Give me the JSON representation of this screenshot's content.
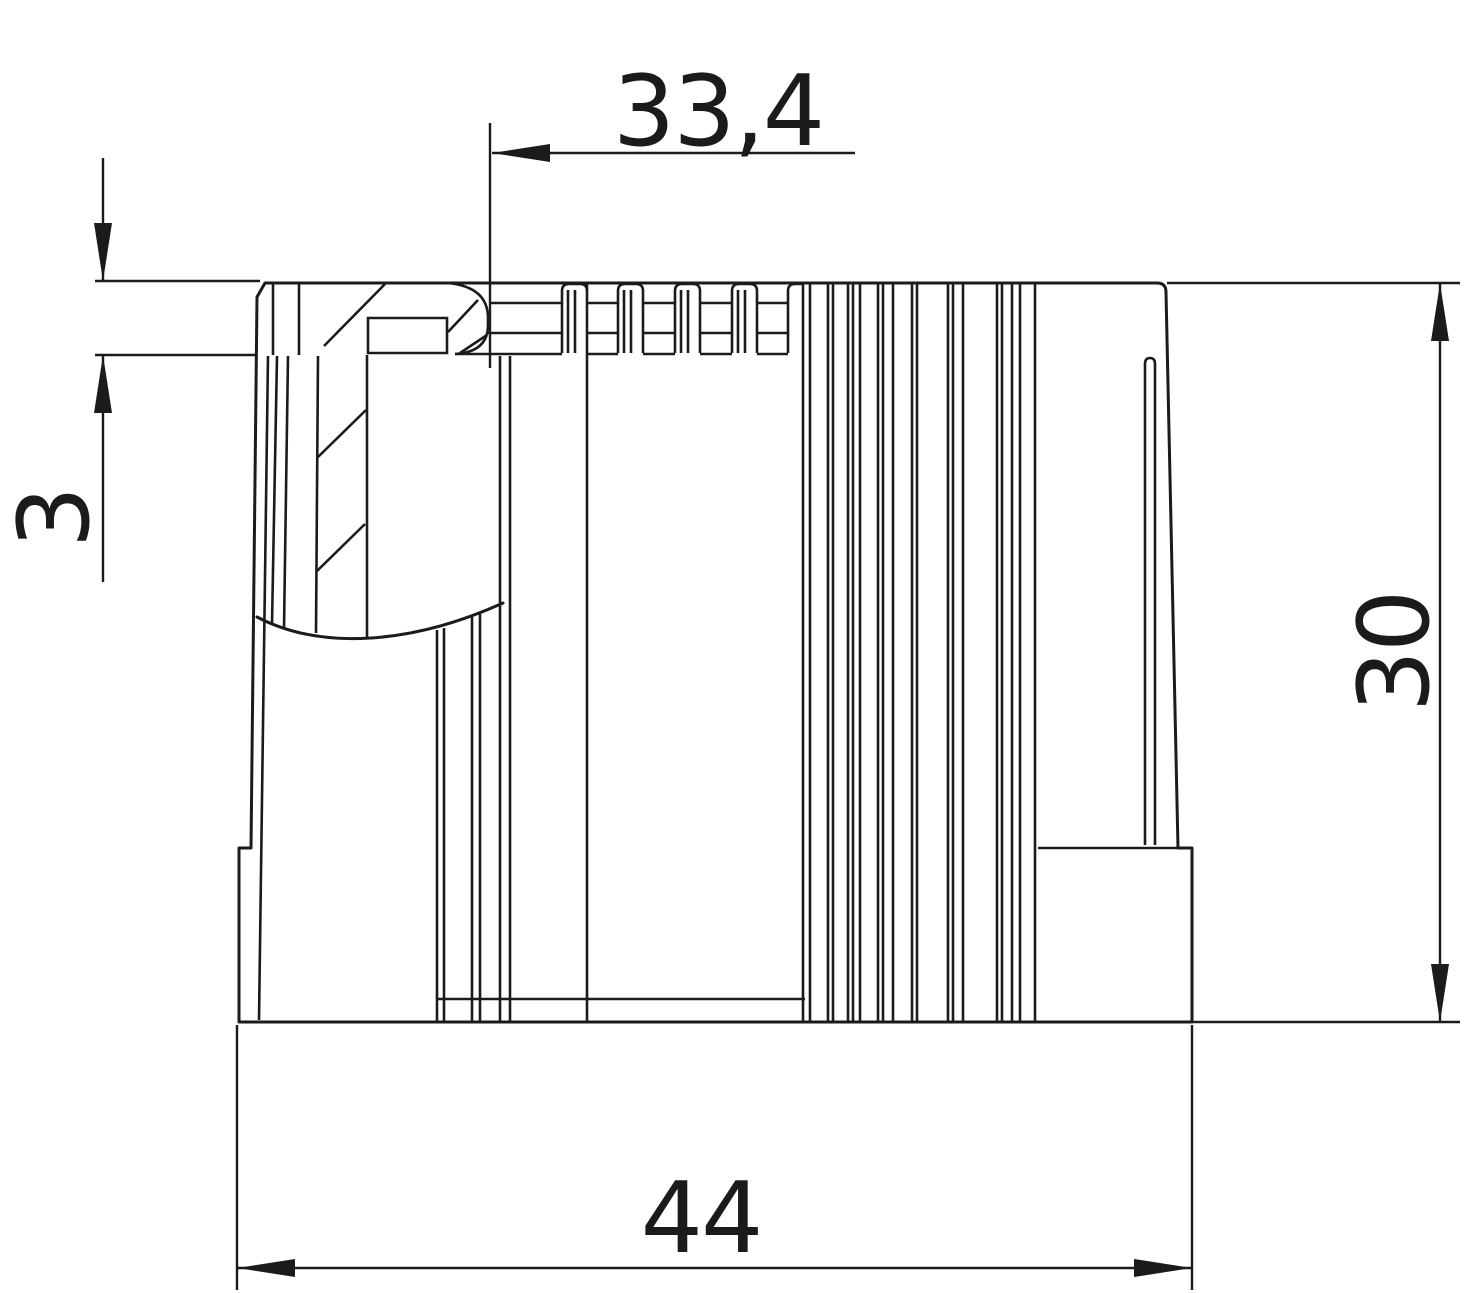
{
  "drawing": {
    "kind": "technical-dimension-drawing",
    "subject": "pipe end sleeve cross-section side view",
    "background_color": "#ffffff",
    "line_color": "#1b1b1b",
    "dimensions": {
      "top_width": {
        "label": "33,4",
        "value": 33.4,
        "orientation": "horizontal"
      },
      "lip_height": {
        "label": "3",
        "value": 3,
        "orientation": "vertical"
      },
      "body_height": {
        "label": "30",
        "value": 30,
        "orientation": "vertical"
      },
      "overall_width": {
        "label": "44",
        "value": 44,
        "orientation": "horizontal"
      }
    }
  }
}
